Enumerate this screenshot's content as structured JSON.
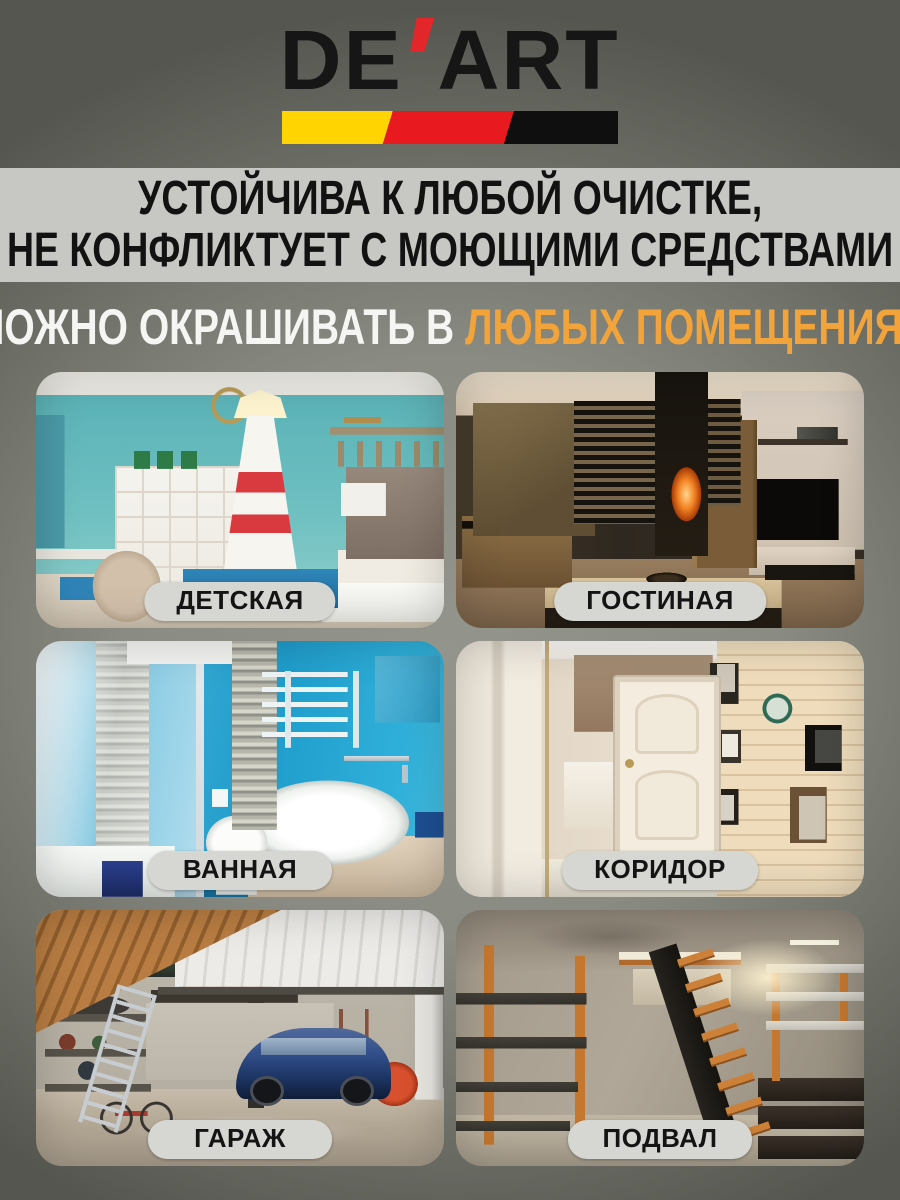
{
  "brand": {
    "full_name": "DE'ART",
    "name_left": "DE",
    "apostrophe": "'",
    "name_right": "ART"
  },
  "claims_banner": {
    "line1": "УСТОЙЧИВА К ЛЮБОЙ ОЧИСТКЕ,",
    "line2": "НЕ КОНФЛИКТУЕТ С МОЮЩИМИ СРЕДСТВАМИ"
  },
  "headline": {
    "prefix": "МОЖНО ОКРАШИВАТЬ В",
    "highlight": "ЛЮБЫХ ПОМЕЩЕНИЯХ"
  },
  "rooms": [
    {
      "label": "ДЕТСКАЯ"
    },
    {
      "label": "ГОСТИНАЯ"
    },
    {
      "label": "ВАННАЯ"
    },
    {
      "label": "КОРИДОР"
    },
    {
      "label": "ГАРАЖ"
    },
    {
      "label": "ПОДВАЛ"
    }
  ],
  "theme": {
    "accent": "#F2A43B",
    "logo_red": "#E2262A",
    "stripe_yellow": "#FFD400",
    "stripe_red": "#E8191F",
    "banner_bg": "#C7C8C4",
    "pill_bg": "#D6D7D2"
  }
}
